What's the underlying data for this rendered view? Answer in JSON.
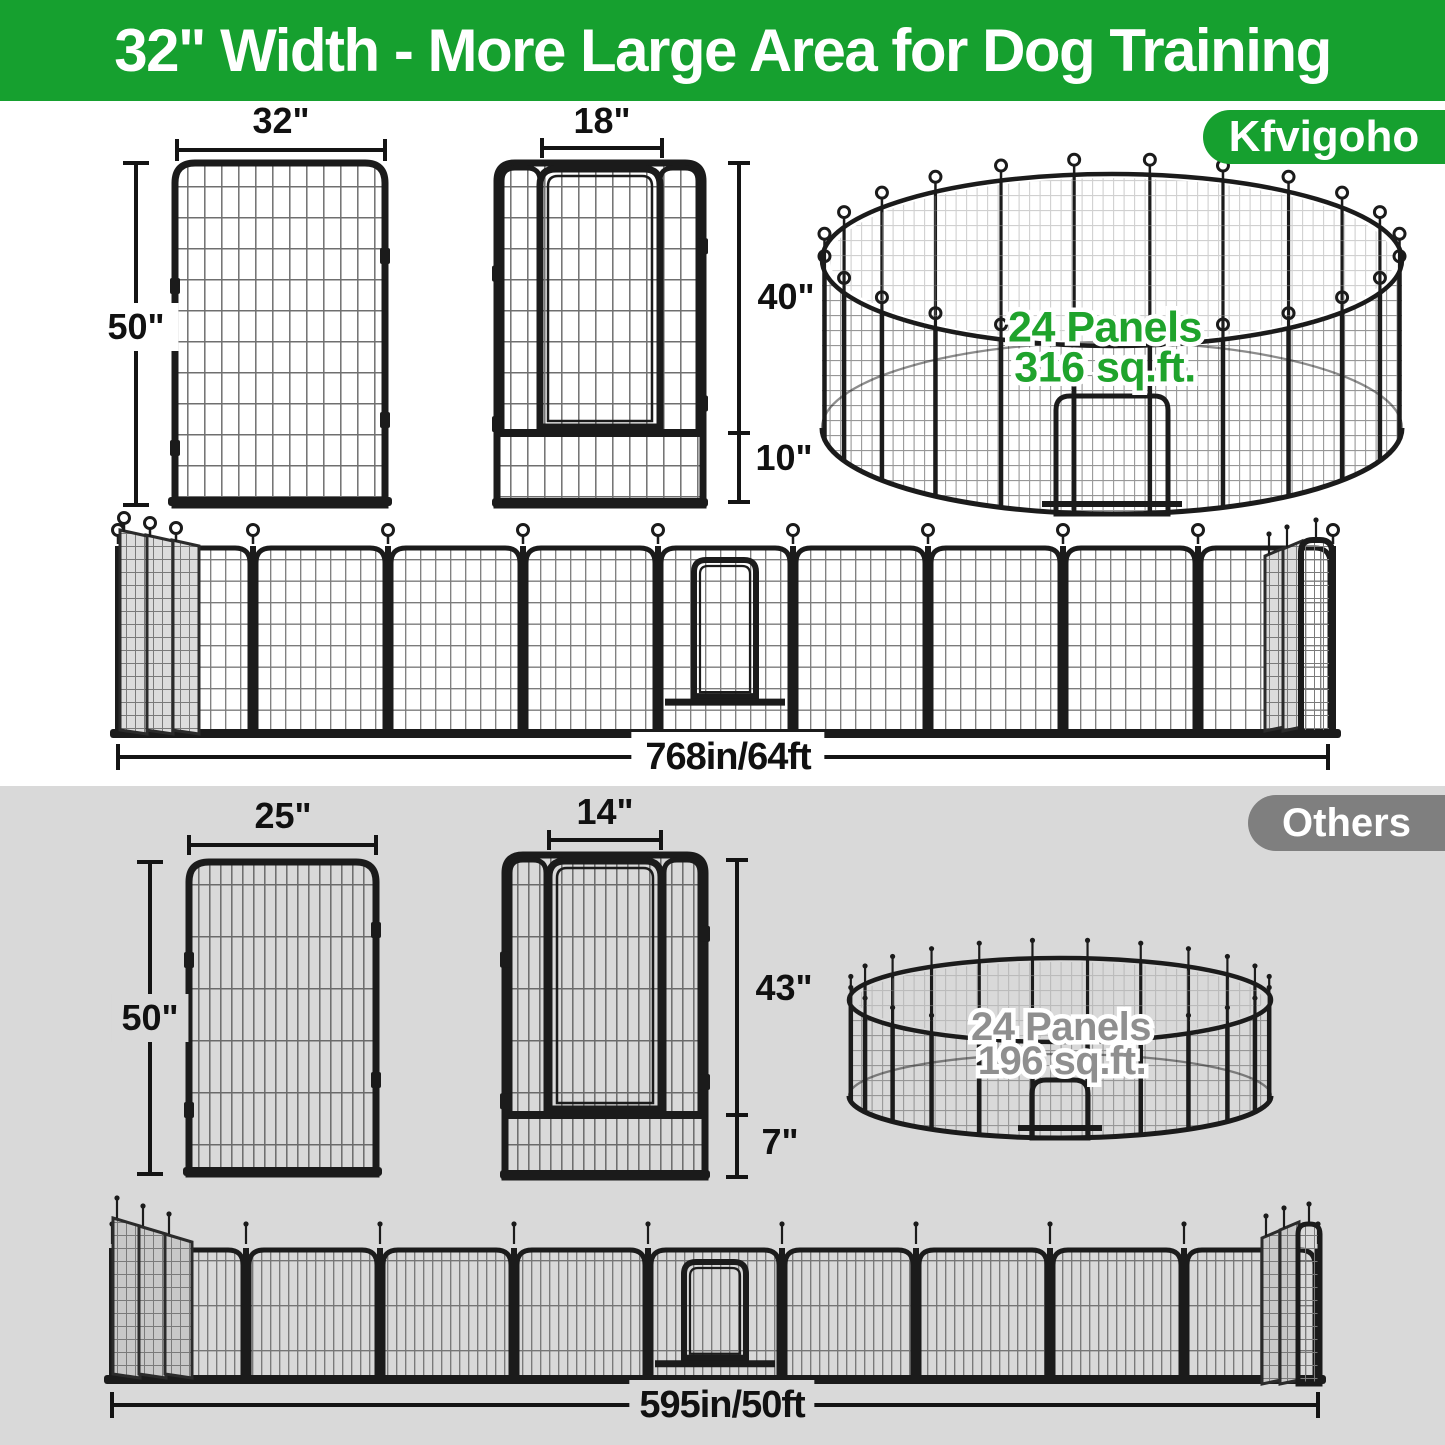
{
  "header": {
    "title": "32\" Width - More Large Area for Dog Training"
  },
  "brand": {
    "name": "Kfvigoho"
  },
  "others": {
    "name": "Others"
  },
  "kfvigoho": {
    "panel": {
      "width": "32\"",
      "height": "50\""
    },
    "door": {
      "width": "18\"",
      "door_height": "40\"",
      "bottom_height": "10\""
    },
    "pen": {
      "panels": "24 Panels",
      "area": "316 sq.ft."
    },
    "row": {
      "length": "768in/64ft"
    }
  },
  "others_brand": {
    "panel": {
      "width": "25\"",
      "height": "50\""
    },
    "door": {
      "width": "14\"",
      "door_height": "43\"",
      "bottom_height": "7\""
    },
    "pen": {
      "panels": "24 Panels",
      "area": "196 sq.ft."
    },
    "row": {
      "length": "595in/50ft"
    }
  },
  "theme": {
    "green": "#16a02f",
    "badge_gray": "#7f7f7f",
    "section_gray": "#d9d9d9",
    "fence": "#1b1b1b",
    "dim": "#141414",
    "text_green": "#1fa32c",
    "text_gray": "#8f8f8f",
    "slab_top": "#dcdcdc",
    "slab_bottom": "#c8c8c8",
    "white": "#ffffff"
  }
}
